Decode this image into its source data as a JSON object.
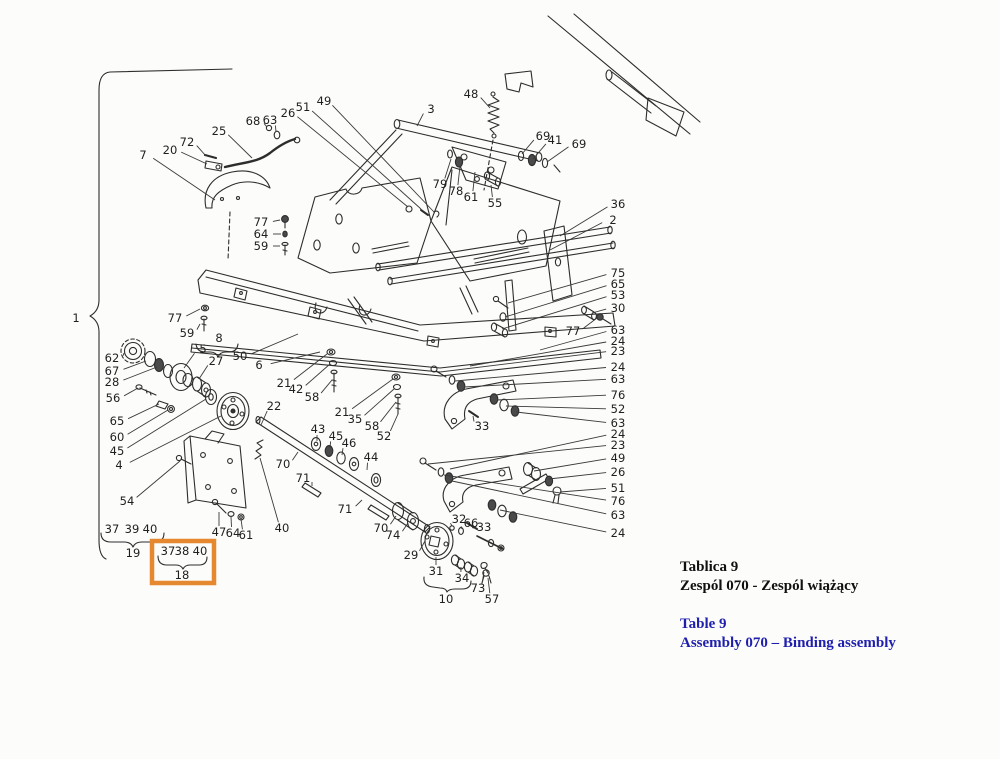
{
  "figure": {
    "kind": "exploded-parts-diagram",
    "language_note": "Polish / English parts-catalog plate"
  },
  "caption": {
    "title_pl_1": "Tablica 9",
    "title_pl_2": "Zespól 070 - Zespól wiążący",
    "title_en_1": "Table 9",
    "title_en_2": "Assembly 070 – Binding assembly"
  },
  "colors": {
    "background": "#fcfcfa",
    "ink": "#2d2d2d",
    "label_text": "#1f1f1f",
    "caption_black": "#101010",
    "caption_blue": "#1f1fae",
    "highlight_orange": "#e5882f"
  },
  "highlight_box": {
    "grouped_parts": [
      "37",
      "38",
      "40"
    ],
    "group_number": "18"
  },
  "group_braces": [
    {
      "group": "1",
      "spans": "entire assembly"
    },
    {
      "group": "8",
      "spans": "5 27"
    },
    {
      "group": "19",
      "spans": "37 39 40"
    },
    {
      "group": "18",
      "spans": "37 38 40"
    },
    {
      "group": "10",
      "spans": "31 34 73"
    }
  ],
  "diagram": {
    "labels": [
      {
        "t": "1",
        "x": 76,
        "y": 318
      },
      {
        "t": "7",
        "x": 143,
        "y": 155,
        "lx": 215,
        "ly": 200
      },
      {
        "t": "20",
        "x": 170,
        "y": 150,
        "lx": 207,
        "ly": 164
      },
      {
        "t": "72",
        "x": 187,
        "y": 142,
        "lx": 206,
        "ly": 156
      },
      {
        "t": "25",
        "x": 219,
        "y": 131,
        "lx": 252,
        "ly": 158
      },
      {
        "t": "68",
        "x": 253,
        "y": 121,
        "lx": 267,
        "ly": 127
      },
      {
        "t": "63",
        "x": 270,
        "y": 120,
        "lx": 276,
        "ly": 132
      },
      {
        "t": "26",
        "x": 288,
        "y": 113,
        "lx": 408,
        "ly": 207
      },
      {
        "t": "51",
        "x": 303,
        "y": 107,
        "lx": 421,
        "ly": 209
      },
      {
        "t": "49",
        "x": 324,
        "y": 101,
        "lx": 434,
        "ly": 212
      },
      {
        "t": "3",
        "x": 431,
        "y": 109,
        "lx": 417,
        "ly": 126
      },
      {
        "t": "48",
        "x": 471,
        "y": 94,
        "lx": 490,
        "ly": 108
      },
      {
        "t": "69",
        "x": 543,
        "y": 136,
        "lx": 522,
        "ly": 154
      },
      {
        "t": "41",
        "x": 555,
        "y": 140,
        "lx": 533,
        "ly": 159
      },
      {
        "t": "69",
        "x": 579,
        "y": 144,
        "lx": 547,
        "ly": 162
      },
      {
        "t": "79",
        "x": 440,
        "y": 184,
        "lx": 451,
        "ly": 159
      },
      {
        "t": "78",
        "x": 456,
        "y": 191,
        "lx": 460,
        "ly": 166
      },
      {
        "t": "61",
        "x": 471,
        "y": 197,
        "lx": 475,
        "ly": 172
      },
      {
        "t": "55",
        "x": 495,
        "y": 203,
        "lx": 491,
        "ly": 185
      },
      {
        "t": "36",
        "x": 618,
        "y": 204,
        "lx": 560,
        "ly": 236
      },
      {
        "t": "2",
        "x": 613,
        "y": 220,
        "lx": 550,
        "ly": 250
      },
      {
        "t": "77",
        "x": 261,
        "y": 222,
        "lx": 280,
        "ly": 220
      },
      {
        "t": "64",
        "x": 261,
        "y": 234,
        "lx": 281,
        "ly": 234
      },
      {
        "t": "59",
        "x": 261,
        "y": 246,
        "lx": 280,
        "ly": 246
      },
      {
        "t": "77",
        "x": 175,
        "y": 318,
        "lx": 200,
        "ly": 309
      },
      {
        "t": "59",
        "x": 187,
        "y": 333,
        "lx": 200,
        "ly": 324
      },
      {
        "t": "8",
        "x": 219,
        "y": 338
      },
      {
        "t": "5",
        "x": 203,
        "y": 349,
        "lx": 184,
        "ly": 368
      },
      {
        "t": "27",
        "x": 216,
        "y": 361,
        "lx": 199,
        "ly": 379
      },
      {
        "t": "50",
        "x": 240,
        "y": 356,
        "lx": 298,
        "ly": 334
      },
      {
        "t": "6",
        "x": 259,
        "y": 365,
        "lx": 320,
        "ly": 352
      },
      {
        "t": "62",
        "x": 112,
        "y": 358,
        "lx": 124,
        "ly": 353
      },
      {
        "t": "67",
        "x": 112,
        "y": 371,
        "lx": 146,
        "ly": 361
      },
      {
        "t": "28",
        "x": 112,
        "y": 382,
        "lx": 157,
        "ly": 367
      },
      {
        "t": "56",
        "x": 113,
        "y": 398,
        "lx": 138,
        "ly": 388
      },
      {
        "t": "65",
        "x": 117,
        "y": 421,
        "lx": 159,
        "ly": 404
      },
      {
        "t": "60",
        "x": 117,
        "y": 437,
        "lx": 168,
        "ly": 410
      },
      {
        "t": "45",
        "x": 117,
        "y": 451,
        "lx": 206,
        "ly": 399
      },
      {
        "t": "4",
        "x": 119,
        "y": 465,
        "lx": 221,
        "ly": 416
      },
      {
        "t": "54",
        "x": 127,
        "y": 501,
        "lx": 180,
        "ly": 461
      },
      {
        "t": "37",
        "x": 112,
        "y": 529
      },
      {
        "t": "39",
        "x": 132,
        "y": 529
      },
      {
        "t": "40",
        "x": 150,
        "y": 529
      },
      {
        "t": "19",
        "x": 133,
        "y": 553
      },
      {
        "t": "47",
        "x": 219,
        "y": 532,
        "lx": 219,
        "ly": 512
      },
      {
        "t": "64",
        "x": 233,
        "y": 533,
        "lx": 231,
        "ly": 517
      },
      {
        "t": "61",
        "x": 246,
        "y": 535,
        "lx": 241,
        "ly": 519
      },
      {
        "t": "40",
        "x": 282,
        "y": 528,
        "lx": 260,
        "ly": 458
      },
      {
        "t": "37",
        "x": 168,
        "y": 551
      },
      {
        "t": "38",
        "x": 182,
        "y": 551
      },
      {
        "t": "40",
        "x": 200,
        "y": 551
      },
      {
        "t": "18",
        "x": 182,
        "y": 575
      },
      {
        "t": "21",
        "x": 284,
        "y": 383,
        "lx": 327,
        "ly": 354
      },
      {
        "t": "42",
        "x": 296,
        "y": 389,
        "lx": 330,
        "ly": 364
      },
      {
        "t": "58",
        "x": 312,
        "y": 397,
        "lx": 332,
        "ly": 380
      },
      {
        "t": "21",
        "x": 342,
        "y": 412,
        "lx": 393,
        "ly": 379
      },
      {
        "t": "35",
        "x": 355,
        "y": 419,
        "lx": 394,
        "ly": 389
      },
      {
        "t": "58",
        "x": 372,
        "y": 426,
        "lx": 396,
        "ly": 402
      },
      {
        "t": "52",
        "x": 384,
        "y": 436,
        "lx": 398,
        "ly": 414
      },
      {
        "t": "22",
        "x": 274,
        "y": 406,
        "lx": 261,
        "ly": 425
      },
      {
        "t": "43",
        "x": 318,
        "y": 429,
        "lx": 317,
        "ly": 441
      },
      {
        "t": "45",
        "x": 336,
        "y": 436,
        "lx": 330,
        "ly": 448
      },
      {
        "t": "46",
        "x": 349,
        "y": 443,
        "lx": 342,
        "ly": 455
      },
      {
        "t": "44",
        "x": 371,
        "y": 457,
        "lx": 367,
        "ly": 470
      },
      {
        "t": "70",
        "x": 283,
        "y": 464,
        "lx": 298,
        "ly": 452
      },
      {
        "t": "71",
        "x": 303,
        "y": 478,
        "lx": 312,
        "ly": 486
      },
      {
        "t": "71",
        "x": 345,
        "y": 509,
        "lx": 362,
        "ly": 500
      },
      {
        "t": "70",
        "x": 381,
        "y": 528,
        "lx": 396,
        "ly": 516
      },
      {
        "t": "74",
        "x": 393,
        "y": 535,
        "lx": 408,
        "ly": 523
      },
      {
        "t": "29",
        "x": 411,
        "y": 555,
        "lx": 425,
        "ly": 541
      },
      {
        "t": "31",
        "x": 436,
        "y": 571,
        "lx": 436,
        "ly": 557
      },
      {
        "t": "32",
        "x": 459,
        "y": 519,
        "lx": 452,
        "ly": 526
      },
      {
        "t": "66",
        "x": 471,
        "y": 523,
        "lx": 462,
        "ly": 529
      },
      {
        "t": "33",
        "x": 484,
        "y": 527,
        "lx": 474,
        "ly": 528
      },
      {
        "t": "34",
        "x": 462,
        "y": 578,
        "lx": 461,
        "ly": 567
      },
      {
        "t": "73",
        "x": 478,
        "y": 588,
        "lx": 484,
        "ly": 572
      },
      {
        "t": "10",
        "x": 446,
        "y": 599
      },
      {
        "t": "57",
        "x": 492,
        "y": 599,
        "lx": 488,
        "ly": 578
      },
      {
        "t": "33",
        "x": 482,
        "y": 426,
        "lx": 473,
        "ly": 416
      },
      {
        "t": "75",
        "x": 618,
        "y": 273,
        "lx": 508,
        "ly": 303
      },
      {
        "t": "65",
        "x": 618,
        "y": 284,
        "lx": 505,
        "ly": 317
      },
      {
        "t": "53",
        "x": 618,
        "y": 295,
        "lx": 502,
        "ly": 329
      },
      {
        "t": "30",
        "x": 618,
        "y": 308,
        "lx": 592,
        "ly": 313
      },
      {
        "t": "77",
        "x": 573,
        "y": 331,
        "lx": 597,
        "ly": 318
      },
      {
        "t": "63",
        "x": 618,
        "y": 330,
        "lx": 540,
        "ly": 350
      },
      {
        "t": "24",
        "x": 618,
        "y": 341,
        "lx": 470,
        "ly": 366
      },
      {
        "t": "23",
        "x": 618,
        "y": 351,
        "lx": 440,
        "ly": 372
      },
      {
        "t": "24",
        "x": 618,
        "y": 367,
        "lx": 455,
        "ly": 381
      },
      {
        "t": "63",
        "x": 618,
        "y": 379,
        "lx": 464,
        "ly": 387
      },
      {
        "t": "76",
        "x": 618,
        "y": 395,
        "lx": 497,
        "ly": 400
      },
      {
        "t": "52",
        "x": 618,
        "y": 409,
        "lx": 506,
        "ly": 406
      },
      {
        "t": "63",
        "x": 618,
        "y": 423,
        "lx": 516,
        "ly": 412
      },
      {
        "t": "24",
        "x": 618,
        "y": 434,
        "lx": 450,
        "ly": 469
      },
      {
        "t": "23",
        "x": 618,
        "y": 445,
        "lx": 428,
        "ly": 464
      },
      {
        "t": "49",
        "x": 618,
        "y": 458,
        "lx": 534,
        "ly": 471
      },
      {
        "t": "26",
        "x": 618,
        "y": 472,
        "lx": 549,
        "ly": 479
      },
      {
        "t": "51",
        "x": 618,
        "y": 488,
        "lx": 560,
        "ly": 492
      },
      {
        "t": "76",
        "x": 618,
        "y": 501,
        "lx": 444,
        "ly": 475
      },
      {
        "t": "63",
        "x": 618,
        "y": 515,
        "lx": 452,
        "ly": 481
      },
      {
        "t": "24",
        "x": 618,
        "y": 533,
        "lx": 500,
        "ly": 510
      }
    ]
  }
}
